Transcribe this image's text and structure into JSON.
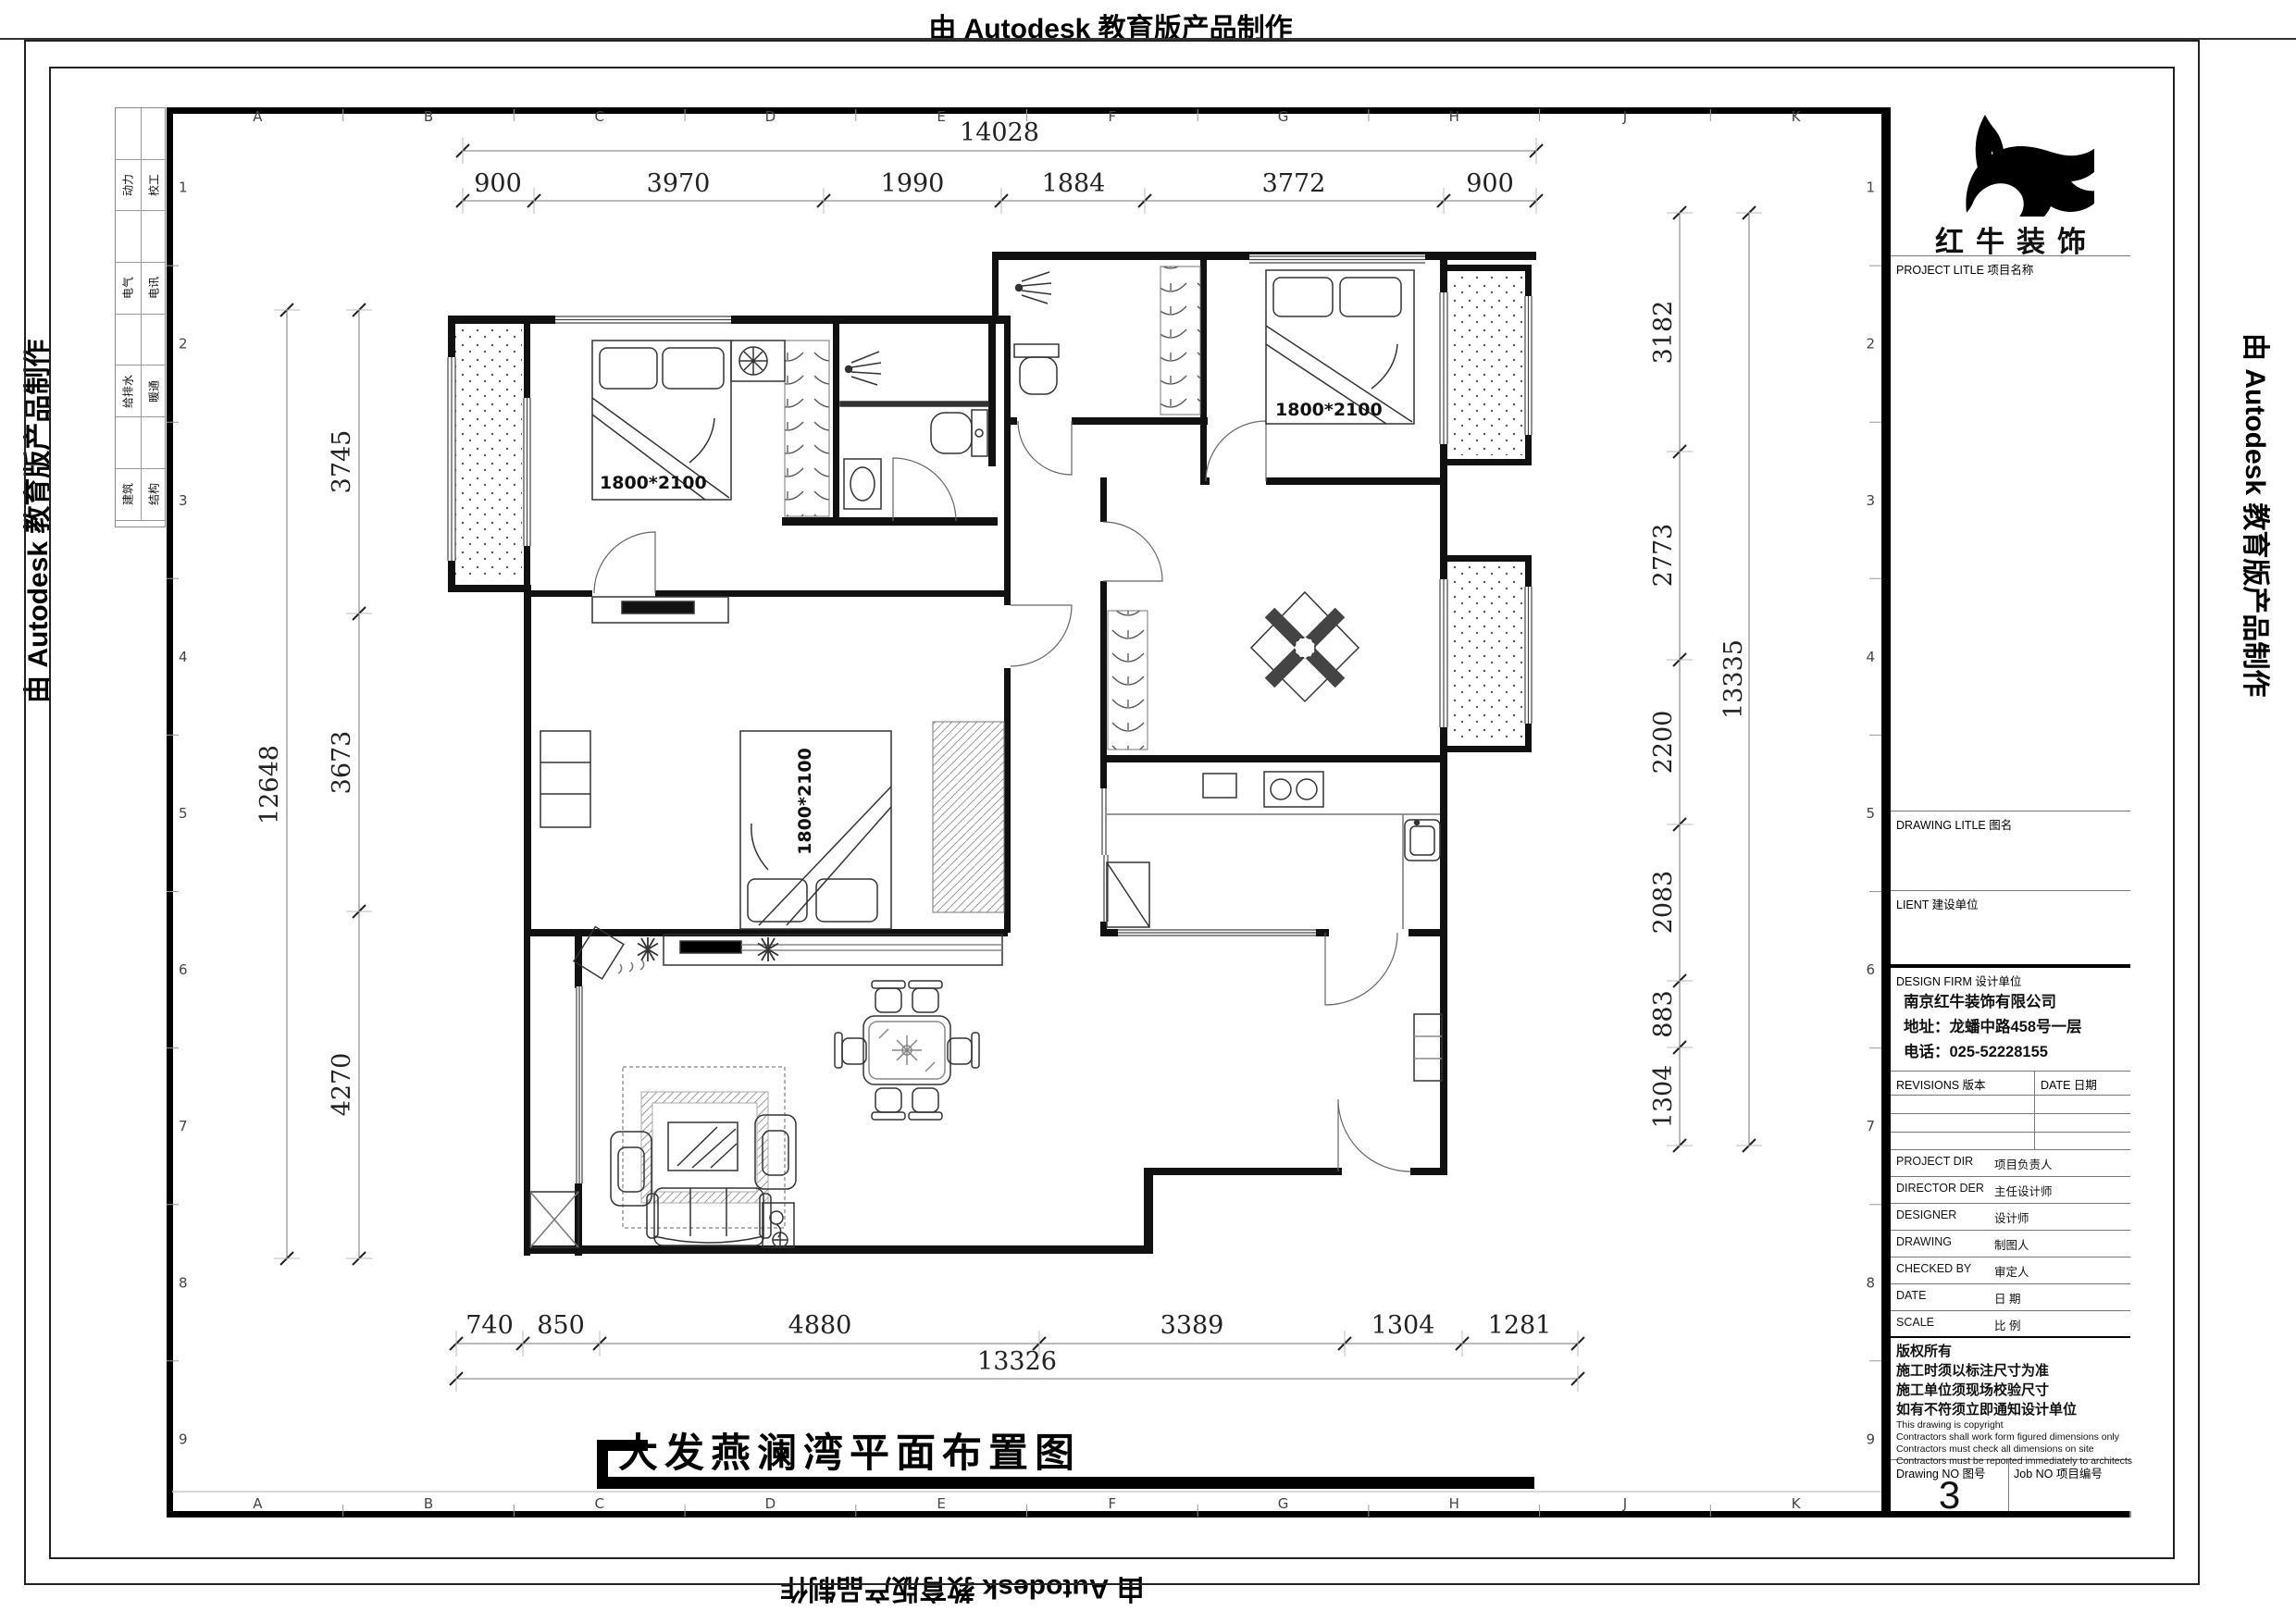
{
  "stamps": {
    "autodesk": "由 Autodesk 教育版产品制作"
  },
  "sheet": {
    "grid_letters": [
      "A",
      "B",
      "C",
      "D",
      "E",
      "F",
      "G",
      "H",
      "J",
      "K"
    ],
    "grid_numbers": [
      "1",
      "2",
      "3",
      "4",
      "5",
      "6",
      "7",
      "8",
      "9"
    ],
    "discipline_table": [
      {
        "left": "动力",
        "right": "校工"
      },
      {
        "left": "电气",
        "right": "电讯"
      },
      {
        "left": "给排水",
        "right": "暖通"
      },
      {
        "left": "建筑",
        "right": "结构"
      }
    ]
  },
  "title": "大发燕澜湾平面布置图",
  "title_block": {
    "logo_text": "红牛装饰",
    "project_label": "PROJECT LITLE  项目名称",
    "drawing_label": "DRAWING LITLE  图名",
    "client_label": "LIENT  建设单位",
    "design_firm_label": "DESIGN FIRM  设计单位",
    "company_name": "南京红牛装饰有限公司",
    "company_address": "地址：龙蟠中路458号一层",
    "company_phone": "电话：025-52228155",
    "revisions_label": "REVISIONS  版本",
    "date_label": "DATE  日期",
    "personnel_rows": [
      {
        "en": "PROJECT DIR",
        "cn": "项目负责人"
      },
      {
        "en": "DIRECTOR DER",
        "cn": "主任设计师"
      },
      {
        "en": "DESIGNER",
        "cn": "设计师"
      },
      {
        "en": "DRAWING",
        "cn": "制图人"
      },
      {
        "en": "CHECKED BY",
        "cn": "审定人"
      },
      {
        "en": "DATE",
        "cn": "日  期"
      },
      {
        "en": "SCALE",
        "cn": "比  例"
      }
    ],
    "copyright_cn": [
      "版权所有",
      "施工时须以标注尺寸为准",
      "施工单位须现场校验尺寸",
      "如有不符须立即通知设计单位"
    ],
    "copyright_en": [
      "This drawing is copyright",
      "Contractors shall work form figured dimensions only",
      "Contractors must check all dimensions on site",
      "Contractors must be reported immediately to architects"
    ],
    "drawing_no_label": "Drawing NO  图号",
    "drawing_no": "3",
    "job_no_label": "Job NO  项目编号"
  },
  "plan": {
    "bed_label": "1800*2100",
    "dims": {
      "top_overall": "14028",
      "top_segments": [
        "900",
        "3970",
        "1990",
        "1884",
        "3772",
        "900"
      ],
      "left_overall": "12648",
      "left_segments": [
        "3745",
        "3673",
        "4270"
      ],
      "right_overall": "13335",
      "right_segments": [
        "3182",
        "2773",
        "2200",
        "2083",
        "883",
        "1304"
      ],
      "bottom_overall": "13326",
      "bottom_segments": [
        "740",
        "850",
        "4880",
        "3389",
        "1304",
        "1281"
      ]
    }
  }
}
